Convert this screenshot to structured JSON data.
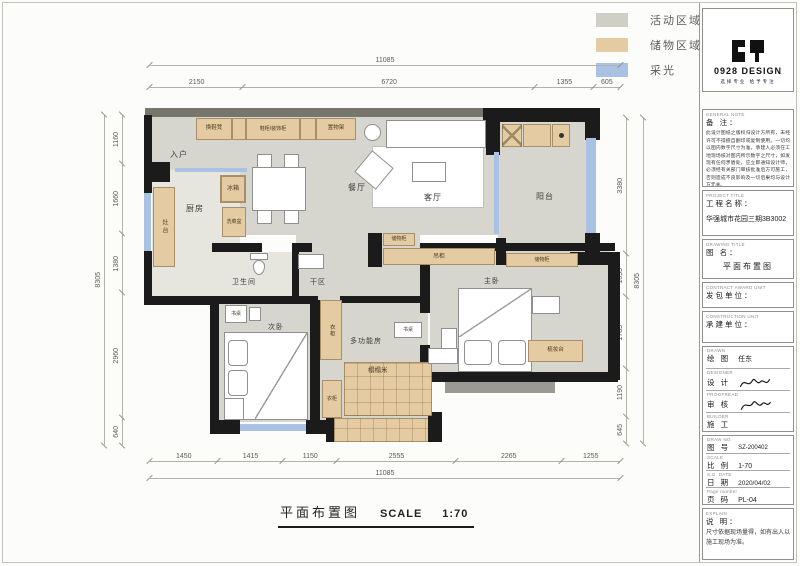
{
  "legend": {
    "items": [
      {
        "label": "活动区域",
        "color": "#cfcfc5"
      },
      {
        "label": "储物区域",
        "color": "#e4cba2"
      },
      {
        "label": "采光",
        "color": "#a9c2e4"
      }
    ]
  },
  "plan": {
    "rooms": {
      "entry": "入户",
      "kitchen": "厨房",
      "dining": "餐厅",
      "living": "客厅",
      "balcony": "阳台",
      "bathroom": "卫生间",
      "dry_area": "干区",
      "bedroom2": "次卧",
      "multi_room": "多功能房",
      "master": "主卧"
    },
    "furniture": {
      "shoe_bench": "换鞋凳",
      "shoe_cabinet": "鞋柜/装饰柜",
      "shelf": "置物架",
      "stove": "灶台",
      "fridge": "冰箱",
      "veg_sink": "洗菜盆",
      "storage_a": "储物柜",
      "tv_cabinet": "吊柜",
      "storage_b": "储物柜",
      "desk_bed2": "书桌",
      "desk_multi": "书桌",
      "wardrobe_a": "衣柜",
      "wardrobe_b": "衣柜",
      "tatami": "榻榻米",
      "dresser": "梳妆台"
    }
  },
  "dims": {
    "top": {
      "total": "11085",
      "segs": [
        "2150",
        "6720",
        "1355",
        "605"
      ]
    },
    "bottom": {
      "total": "11085",
      "segs": [
        "1450",
        "1415",
        "1150",
        "2555",
        "2265",
        "1255"
      ]
    },
    "left": {
      "total": "8305",
      "segs": [
        "1160",
        "1660",
        "1380",
        "2960",
        "640"
      ]
    },
    "right": {
      "total": "8305",
      "segs": [
        "3380",
        "1055",
        "1785",
        "1190",
        "645"
      ]
    }
  },
  "caption": {
    "title": "平面布置图",
    "scale_label": "SCALE",
    "scale_value": "1:70"
  },
  "titleblock": {
    "logo": {
      "title": "0928 DESIGN",
      "tagline": "选择专业 给予专注"
    },
    "note": {
      "en": "GENERAL NOTE",
      "label": "备 注：",
      "text": "此设计图纸之版权归设计方所有，未经许可不得擅自翻印或复制使用。一切均以图内数字尺寸为准，承建人必须在工地现场核对图内所示数字之尺寸，如发现有任何矛盾处，应立即通知设计师，必须经有关部门审核批准后方可施工，否则造成不良影响及一切后果均与设计方无关。"
    },
    "project": {
      "en": "PROJECT TITLE",
      "label": "工程名称：",
      "value": "华强城市花园三期3B3002"
    },
    "drawing": {
      "en": "DRAWING TITLE",
      "label": "图 名：",
      "value": "平面布置图"
    },
    "contract": {
      "en": "CONTRACT AWARD UNIT",
      "label": "发包单位："
    },
    "construct": {
      "en": "CONSTRUCTION UNIT",
      "label": "承建单位："
    },
    "drawn": {
      "en": "DRAWN",
      "label": "绘 图",
      "value": "任东"
    },
    "designer": {
      "en": "DESIGNER",
      "label": "设 计"
    },
    "proofread": {
      "en": "PROOFREAD",
      "label": "审 核"
    },
    "builder": {
      "en": "BUILDER",
      "label": "施 工"
    },
    "draw_no": {
      "en": "DRAW NO.",
      "label": "图 号",
      "value": "SZ-200402"
    },
    "scale": {
      "en": "SCALE",
      "label": "比 例",
      "value": "1-70"
    },
    "date": {
      "en": "S.G. DATE",
      "label": "日 期",
      "value": "2020/04/02"
    },
    "page": {
      "en": "Page number",
      "label": "页 码",
      "value": "PL-04"
    },
    "explain": {
      "en": "EXPLAIN",
      "label": "说 明：",
      "text": "尺寸依据现场量得，如有出入以施工现场为准。"
    }
  }
}
